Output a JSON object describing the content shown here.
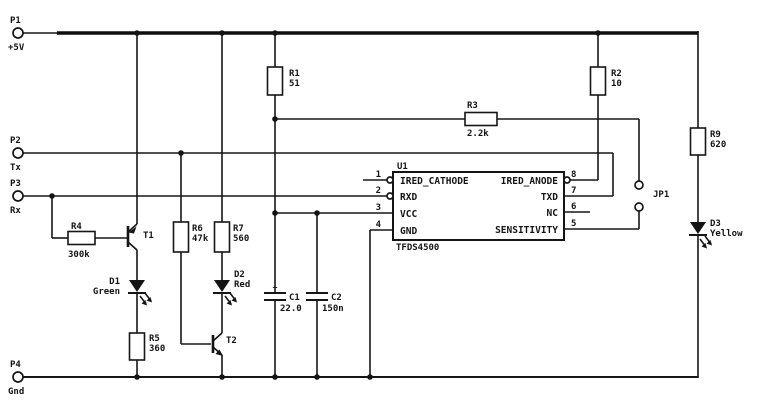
{
  "schematic": {
    "colors": {
      "ink": "#141414",
      "background": "#ffffff"
    },
    "ports": [
      {
        "id": "P1",
        "signal": "+5V"
      },
      {
        "id": "P2",
        "signal": "Tx"
      },
      {
        "id": "P3",
        "signal": "Rx"
      },
      {
        "id": "P4",
        "signal": "Gnd"
      }
    ],
    "resistors": [
      {
        "id": "R1",
        "value": "51"
      },
      {
        "id": "R2",
        "value": "10"
      },
      {
        "id": "R3",
        "value": "2.2k"
      },
      {
        "id": "R4",
        "value": "300k"
      },
      {
        "id": "R5",
        "value": "360"
      },
      {
        "id": "R6",
        "value": "47k"
      },
      {
        "id": "R7",
        "value": "560"
      },
      {
        "id": "R9",
        "value": "620"
      }
    ],
    "capacitors": [
      {
        "id": "C1",
        "value": "22.0",
        "polarity": "+"
      },
      {
        "id": "C2",
        "value": "150n"
      }
    ],
    "leds": [
      {
        "id": "D1",
        "color": "Green"
      },
      {
        "id": "D2",
        "color": "Red"
      },
      {
        "id": "D3",
        "color": "Yellow"
      }
    ],
    "transistors": [
      {
        "id": "T1"
      },
      {
        "id": "T2"
      }
    ],
    "jumper": {
      "id": "JP1"
    },
    "ic": {
      "ref": "U1",
      "part": "TFDS4500",
      "pins_left": [
        {
          "num": "1",
          "name": "IRED_CATHODE"
        },
        {
          "num": "2",
          "name": "RXD"
        },
        {
          "num": "3",
          "name": "VCC"
        },
        {
          "num": "4",
          "name": "GND"
        }
      ],
      "pins_right": [
        {
          "num": "8",
          "name": "IRED_ANODE"
        },
        {
          "num": "7",
          "name": "TXD"
        },
        {
          "num": "6",
          "name": "NC"
        },
        {
          "num": "5",
          "name": "SENSITIVITY"
        }
      ]
    }
  }
}
